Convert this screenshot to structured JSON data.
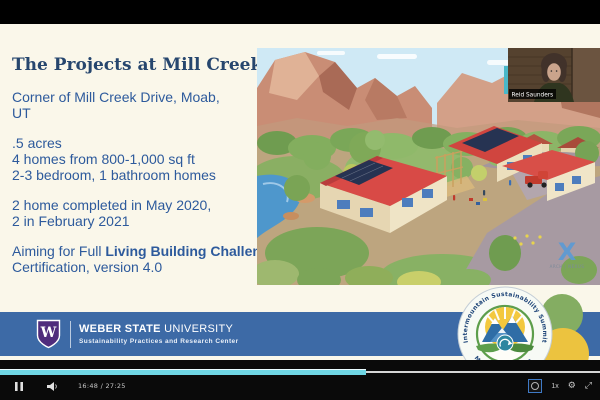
{
  "player": {
    "time_display": "16:48 / 27:25",
    "progress_percent": 61,
    "speed_label": "1x",
    "gear_glyph": "⚙",
    "fullscreen_glyph": "⤢"
  },
  "slide": {
    "title": "The Projects at Mill Creek",
    "location_lines": [
      "Corner of Mill Creek Drive, Moab,",
      "UT"
    ],
    "facts": [
      ".5 acres",
      "4 homes from 800-1,000 sq ft",
      "2-3 bedroom, 1 bathroom homes"
    ],
    "completion_lines": [
      "2 home completed in May 2020,",
      "2 in February 2021"
    ],
    "aiming": {
      "prefix": "Aiming for Full ",
      "bold": "Living Building Challenge",
      "suffix": " Certification, version 4.0"
    }
  },
  "webcam": {
    "name_tag": "Reid Saunders"
  },
  "banner": {
    "shield_letter": "W",
    "org_bold": "WEBER STATE",
    "org_regular": " UNIVERSITY",
    "subtitle": "Sustainability Practices and Research Center"
  },
  "badge": {
    "arc_top": "Intermountain Sustainability Summit",
    "arc_bottom": "March 18 & 19, 2021"
  },
  "render": {
    "watermark_letter": "X",
    "watermark_text": "ARCH | NEXUS"
  },
  "colors": {
    "slide_bg": "#faf7ea",
    "title_text": "#26466e",
    "body_text": "#2d5a9c",
    "banner_blue": "#3d6aa6",
    "shield_purple": "#4f2c7c",
    "badge_navy": "#1d4478",
    "badge_green": "#5d9e4c",
    "circle_green": "#84ad62",
    "circle_yellow": "#ecc33f",
    "progress_cyan": "#6fd6e4",
    "roof_red": "#d84a46",
    "cliff_rose": "#c98d75",
    "river_blue": "#4e97cc"
  }
}
